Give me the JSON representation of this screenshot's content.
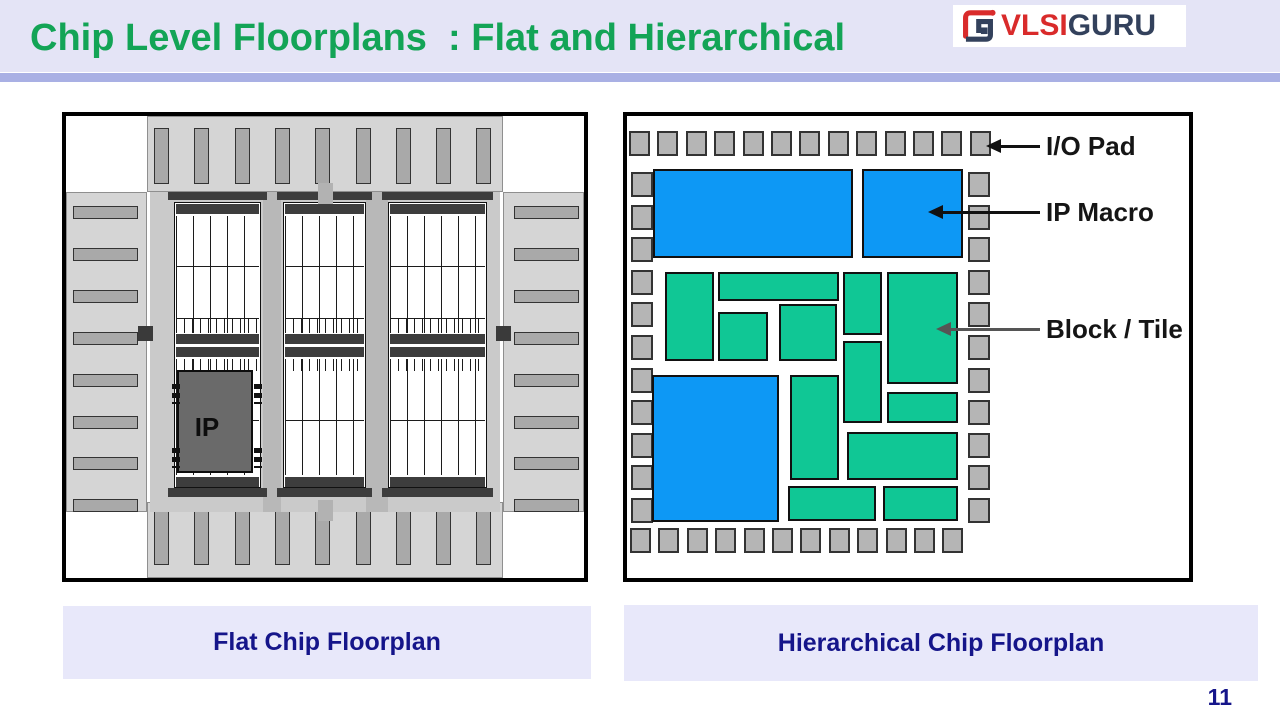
{
  "header": {
    "title": "Chip Level Floorplans  : Flat and Hierarchical",
    "logo_vlsi": "VLSI",
    "logo_guru": "GURU"
  },
  "page_number": "11",
  "colors": {
    "title_green": "#13a456",
    "navy": "#15158a",
    "macro_blue": "#0d98f5",
    "tile_green": "#10c795",
    "pad_gray": "#b5b5b5",
    "header_lavender": "#e4e4f6",
    "divider_periwinkle": "#a9b0e4"
  },
  "flat_diagram": {
    "caption": "Flat Chip Floorplan",
    "ip_label": "IP",
    "pad_counts": {
      "top": 9,
      "bottom": 9,
      "left": 8,
      "right": 8
    }
  },
  "hier_diagram": {
    "caption": "Hierarchical Chip Floorplan",
    "pad_counts": {
      "top": 13,
      "bottom": 12,
      "left": 11,
      "right": 11
    },
    "annotations": [
      {
        "text": "I/O Pad"
      },
      {
        "text": "IP Macro"
      },
      {
        "text": "Block / Tile"
      }
    ],
    "macros": [
      [
        26,
        53,
        200,
        89
      ],
      [
        235,
        53,
        101,
        89
      ],
      [
        25,
        259,
        127,
        147
      ]
    ],
    "tiles": [
      [
        38,
        156,
        49,
        89
      ],
      [
        91,
        156,
        121,
        29
      ],
      [
        91,
        196,
        50,
        49
      ],
      [
        152,
        188,
        58,
        57
      ],
      [
        216,
        156,
        39,
        63
      ],
      [
        260,
        156,
        71,
        112
      ],
      [
        216,
        225,
        39,
        82
      ],
      [
        260,
        276,
        71,
        31
      ],
      [
        163,
        259,
        49,
        105
      ],
      [
        220,
        316,
        111,
        48
      ],
      [
        161,
        370,
        88,
        35
      ],
      [
        256,
        370,
        75,
        35
      ]
    ]
  }
}
